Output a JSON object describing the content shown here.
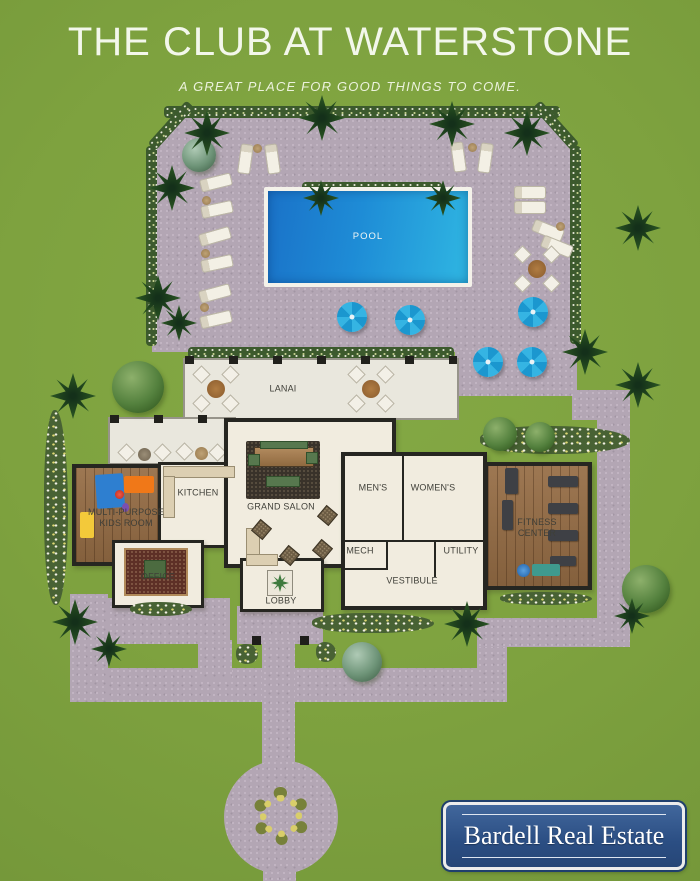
{
  "header": {
    "title": "THE CLUB AT WATERSTONE",
    "subtitle": "A GREAT PLACE FOR GOOD THINGS TO COME."
  },
  "plan": {
    "pool": "POOL",
    "lanai": "LANAI",
    "kitchen": "KITCHEN",
    "grand_salon": "GRAND SALON",
    "kids_room": "MULTI-PURPOSE KIDS ROOM",
    "office": "OFFICE",
    "lobby": "LOBBY",
    "mens": "MEN'S",
    "womens": "WOMEN'S",
    "mech": "MECH",
    "utility": "UTILITY",
    "vestibule": "VESTIBULE",
    "fitness": "FITNESS CENTER"
  },
  "logo": {
    "name": "Bardell Real Estate"
  },
  "colors": {
    "grass": "#7ea23f",
    "paving": "#b3a6b4",
    "pool_blue": "#1e8cd6",
    "umbrella_blue": "#1b97cf",
    "logo_blue": "#2b4e83",
    "wall": "#262621",
    "floor": "#f1ecdf"
  }
}
